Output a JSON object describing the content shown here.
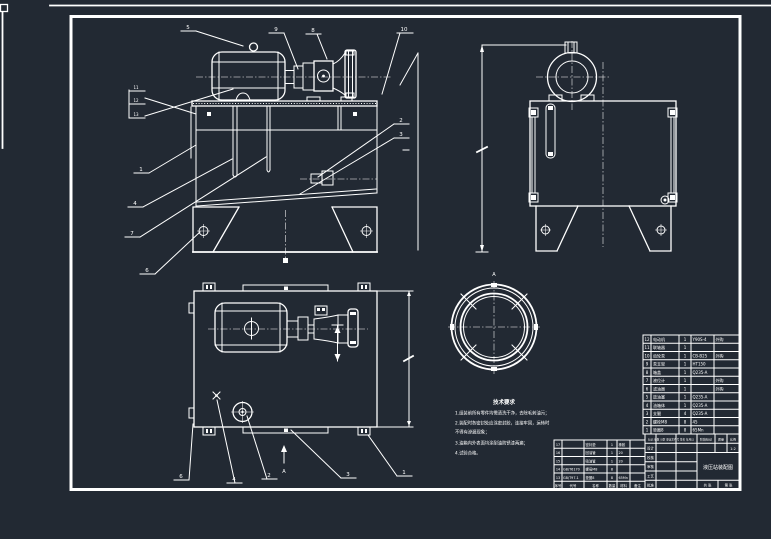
{
  "colors": {
    "background": "#222933",
    "line": "#ffffff"
  },
  "balloons": {
    "front_top": [
      "5",
      "9",
      "8",
      "10"
    ],
    "front_right": [
      "2",
      "3"
    ],
    "front_left": [
      "1",
      "4",
      "7",
      "6"
    ],
    "front_stack": [
      "11",
      "12",
      "13"
    ],
    "top_bottom": [
      "6",
      "4",
      "2",
      "3",
      "1"
    ],
    "view_arrow_label": "A",
    "detail_label": "A"
  },
  "tech_requirements": {
    "title": "技术要求",
    "line1": "1.组装前所有零件均需清洗干净，去除毛刺油污；",
    "line2": "2.装配时各密封处应涂密封胶，连接牢固，运转时",
    "line2b": "不得有渗漏现象；",
    "line3": "3.油箱内外表面均涂耐油防锈漆两遍；",
    "line4": "4.试验合格。"
  },
  "parts_list": {
    "rows": [
      {
        "no": "12",
        "name": "电动机",
        "qty": "1",
        "mat": "Y90S-4",
        "rem": "外购"
      },
      {
        "no": "11",
        "name": "联轴器",
        "qty": "1",
        "mat": "",
        "rem": ""
      },
      {
        "no": "10",
        "name": "齿轮泵",
        "qty": "1",
        "mat": "CB-B25",
        "rem": "外购"
      },
      {
        "no": "9",
        "name": "泵支架",
        "qty": "1",
        "mat": "HT150",
        "rem": ""
      },
      {
        "no": "8",
        "name": "箱盖",
        "qty": "1",
        "mat": "Q235-A",
        "rem": ""
      },
      {
        "no": "7",
        "name": "液位计",
        "qty": "1",
        "mat": "",
        "rem": "外购"
      },
      {
        "no": "6",
        "name": "滤油器",
        "qty": "1",
        "mat": "",
        "rem": "外购"
      },
      {
        "no": "5",
        "name": "放油塞",
        "qty": "1",
        "mat": "Q235-A",
        "rem": ""
      },
      {
        "no": "4",
        "name": "油箱体",
        "qty": "1",
        "mat": "Q235-A",
        "rem": ""
      },
      {
        "no": "3",
        "name": "支腿",
        "qty": "4",
        "mat": "Q235-A",
        "rem": ""
      },
      {
        "no": "2",
        "name": "螺栓M8",
        "qty": "8",
        "mat": "45",
        "rem": ""
      },
      {
        "no": "1",
        "name": "垫圈8",
        "qty": "8",
        "mat": "65Mn",
        "rem": ""
      }
    ]
  },
  "parts_list2": {
    "header": {
      "no": "序号",
      "code": "代号",
      "name": "名称",
      "qty": "数量",
      "mat": "材料",
      "rem": "备注"
    },
    "rows": [
      {
        "no": "17",
        "code": "",
        "name": "密封垫",
        "qty": "1",
        "mat": "橡胶"
      },
      {
        "no": "16",
        "code": "",
        "name": "回油管",
        "qty": "1",
        "mat": "20"
      },
      {
        "no": "15",
        "code": "",
        "name": "吸油管",
        "qty": "1",
        "mat": "20"
      },
      {
        "no": "14",
        "code": "GB/T6170",
        "name": "螺母M8",
        "qty": "8",
        "mat": ""
      },
      {
        "no": "13",
        "code": "GB/T97.1",
        "name": "垫圈8",
        "qty": "8",
        "mat": "65Mn"
      }
    ]
  },
  "title_block": {
    "revision_header": "标记 处数 分区 更改文件号 签名 年月日",
    "sign_rows": [
      "设计",
      "校核",
      "审核",
      "工艺",
      "批准"
    ],
    "stage_label": "阶段标记",
    "mass_label": "质量",
    "scale_label": "比例",
    "scale_value": "1:2",
    "title": "液压站装配图",
    "sheet_total": "共 张",
    "sheet_no": "第 张"
  }
}
